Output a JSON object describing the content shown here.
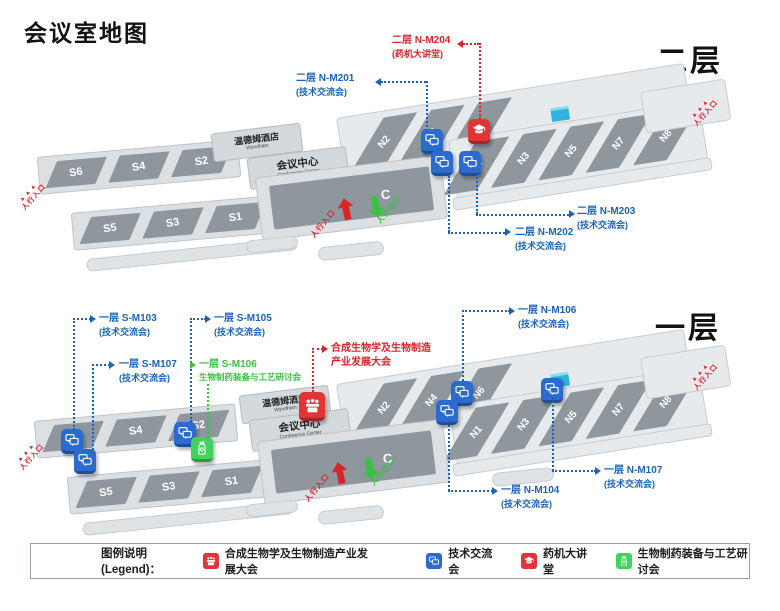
{
  "title": "会议室地图",
  "venue": {
    "hotel": "温德姆酒店",
    "hotel_en": "Wyndham",
    "conf": "会议中心",
    "conf_en": "Conference Center",
    "hall_c": "C"
  },
  "markers": {
    "entrance": "人行入口",
    "exit": "人行出口",
    "arrows": "▲▲▲"
  },
  "colors": {
    "annotation_blue": "#1a63b8",
    "annotation_red": "#d8252b",
    "annotation_green": "#3cc044",
    "badge_blue": "#2b6bd0",
    "badge_red": "#e03436",
    "badge_green": "#42d35e",
    "hall_gray": "#8e969e",
    "slab_gray": "#dce0e3",
    "cyan_block": "#2fb3dd"
  },
  "floors": [
    {
      "label": "二层",
      "halls": {
        "s_top": [
          "S6",
          "S4",
          "S2"
        ],
        "s_bottom": [
          "S5",
          "S3",
          "S1"
        ],
        "n_top": [
          "N2",
          "N4",
          "N6"
        ],
        "n_bottom": [
          "N1",
          "N3",
          "N5",
          "N7",
          "N8"
        ]
      },
      "annotations": {
        "nm204": {
          "line1": "二层 N-M204",
          "line2": "(药机大讲堂)"
        },
        "nm201": {
          "line1": "二层 N-M201",
          "line2": "(技术交流会)"
        },
        "nm202": {
          "line1": "二层 N-M202",
          "line2": "(技术交流会)"
        },
        "nm203": {
          "line1": "二层 N-M203",
          "line2": "(技术交流会)"
        }
      }
    },
    {
      "label": "一层",
      "halls": {
        "s_top": [
          "S6",
          "S4",
          "S2"
        ],
        "s_bottom": [
          "S5",
          "S3",
          "S1"
        ],
        "n_top": [
          "N2",
          "N4",
          "N6"
        ],
        "n_bottom": [
          "N1",
          "N3",
          "N5",
          "N7",
          "N8"
        ]
      },
      "annotations": {
        "sm103": {
          "line1": "一层 S-M103",
          "line2": "(技术交流会)"
        },
        "sm105": {
          "line1": "一层 S-M105",
          "line2": "(技术交流会)"
        },
        "sm107": {
          "line1": "一层 S-M107",
          "line2": "(技术交流会)"
        },
        "sm106": {
          "line1": "一层 S-M106",
          "line2": "生物制药装备与工艺研讨会"
        },
        "synbio": {
          "line1": "合成生物学及生物制造",
          "line2": "产业发展大会"
        },
        "nm106": {
          "line1": "一层 N-M106",
          "line2": "(技术交流会)"
        },
        "nm107": {
          "line1": "一层 N-M107",
          "line2": "(技术交流会)"
        },
        "nm104": {
          "line1": "一层 N-M104",
          "line2": "(技术交流会)"
        }
      }
    }
  ],
  "legend": {
    "label": "图例说明(Legend)：",
    "items": [
      {
        "icon": "conference-icon",
        "label": "合成生物学及生物制造产业发展大会",
        "color": "#e03436"
      },
      {
        "icon": "chat-icon",
        "label": "技术交流会",
        "color": "#2b6bd0"
      },
      {
        "icon": "lecture-icon",
        "label": "药机大讲堂",
        "color": "#e03436"
      },
      {
        "icon": "workshop-icon",
        "label": "生物制药装备与工艺研讨会",
        "color": "#42d35e"
      }
    ]
  }
}
